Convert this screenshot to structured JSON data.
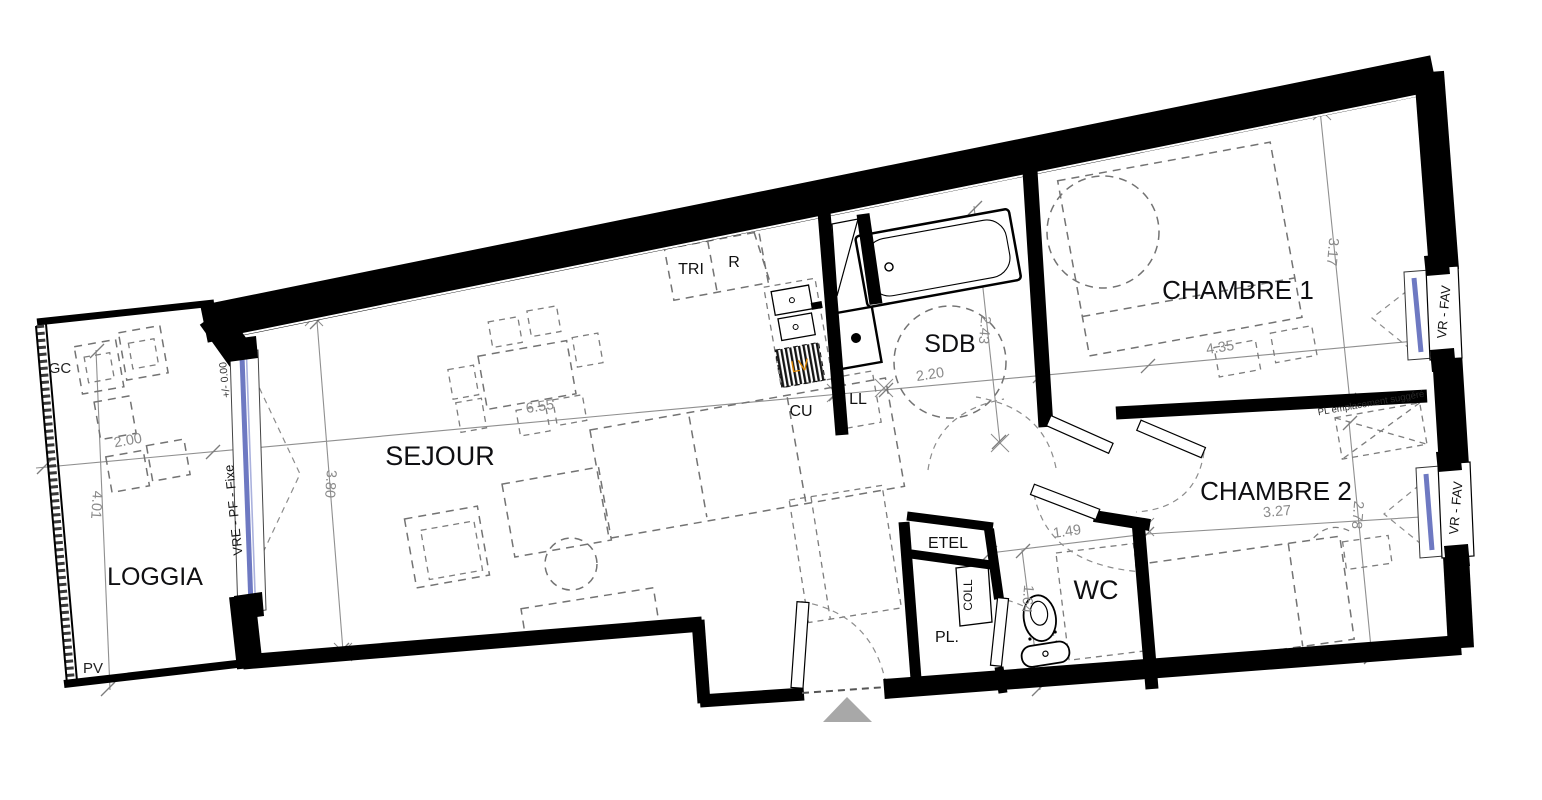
{
  "plan": {
    "type": "apartment-floor-plan",
    "colors": {
      "wall": "#000000",
      "room_label": "#0f0f12",
      "dimension": "#8a8a8a",
      "lv_accent": "#dd8500",
      "window_glass": "#6e79c2",
      "entrance_arrow": "#a8a8a8"
    }
  },
  "rooms": {
    "sejour": "SEJOUR",
    "loggia": "LOGGIA",
    "chambre1": "CHAMBRE 1",
    "chambre2": "CHAMBRE 2",
    "sdb": "SDB",
    "wc": "WC",
    "cu": "CU",
    "ll": "LL",
    "lv": "LV",
    "tri": "TRI",
    "r": "R",
    "etel": "ETEL",
    "coll": "COLL",
    "pl": "PL."
  },
  "dims": {
    "loggia_width": "2.00",
    "loggia_depth": "4.01",
    "sejour_width": "6.55",
    "sejour_depth": "3.80",
    "sdb_width": "2.20",
    "sdb_depth": "2.43",
    "chambre1_width": "4.35",
    "chambre1_depth": "3.17",
    "chambre2_width": "3.27",
    "chambre2_depth": "2.78",
    "wc_width": "1.49",
    "wc_depth": "1.64"
  },
  "ann": {
    "gc": "GC",
    "pv": "PV",
    "level": "+/- 0.00",
    "window_left": "VRE - PF - Fixe",
    "window_right_top": "VR - FAV",
    "window_right_bottom": "VR - FAV",
    "pl_suggere": "PL emplacement suggéré"
  }
}
